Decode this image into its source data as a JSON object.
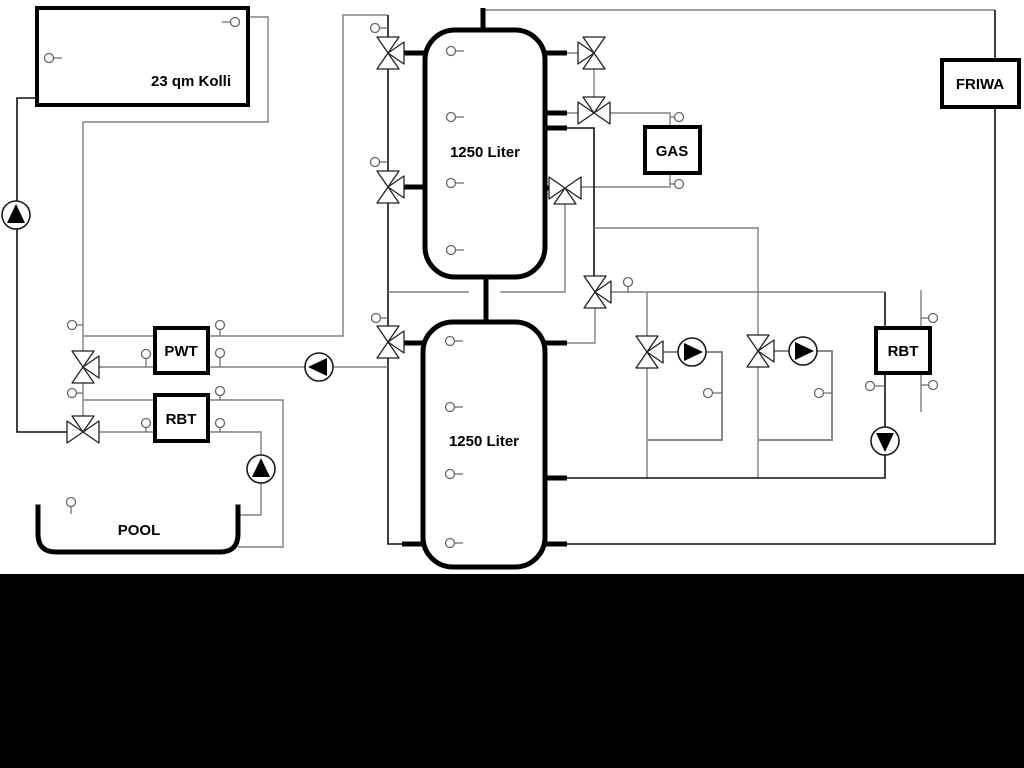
{
  "diagram": {
    "labels": {
      "collector": "23 qm Kolli",
      "tank1": "1250 Liter",
      "tank2": "1250 Liter",
      "gas": "GAS",
      "friwa": "FRIWA",
      "pwt": "PWT",
      "rbt_pool": "RBT",
      "rbt_heating": "RBT",
      "pool": "POOL"
    },
    "colors": {
      "background": "#ffffff",
      "pipe_gray": "#808080",
      "pipe_black": "#111111",
      "component_outline": "#000000",
      "bottom_bar": "#000000"
    },
    "components": {
      "pumps": [
        {
          "name": "solar-pump",
          "direction": "up"
        },
        {
          "name": "buffer-charge-pump",
          "direction": "left"
        },
        {
          "name": "pool-pump",
          "direction": "up"
        },
        {
          "name": "heating-circuit-1-pump",
          "direction": "right"
        },
        {
          "name": "heating-circuit-2-pump",
          "direction": "right"
        },
        {
          "name": "rbt-return-pump",
          "direction": "down"
        }
      ],
      "valves": [
        {
          "name": "tank1-top-charge-valve",
          "type": "three-way"
        },
        {
          "name": "tank1-mid-charge-valve",
          "type": "three-way"
        },
        {
          "name": "tank2-charge-valve",
          "type": "three-way"
        },
        {
          "name": "pwt-primary-valve",
          "type": "three-way"
        },
        {
          "name": "pool-primary-valve",
          "type": "three-way"
        },
        {
          "name": "gas-flow-valve",
          "type": "three-way"
        },
        {
          "name": "tank1-top-outlet-valve",
          "type": "three-way"
        },
        {
          "name": "gas-return-valve",
          "type": "three-way"
        },
        {
          "name": "heating-flow-valve",
          "type": "three-way"
        },
        {
          "name": "heating-circuit-1-valve",
          "type": "three-way"
        },
        {
          "name": "heating-circuit-2-valve",
          "type": "three-way"
        }
      ],
      "temperature_sensor_count": 30
    }
  }
}
